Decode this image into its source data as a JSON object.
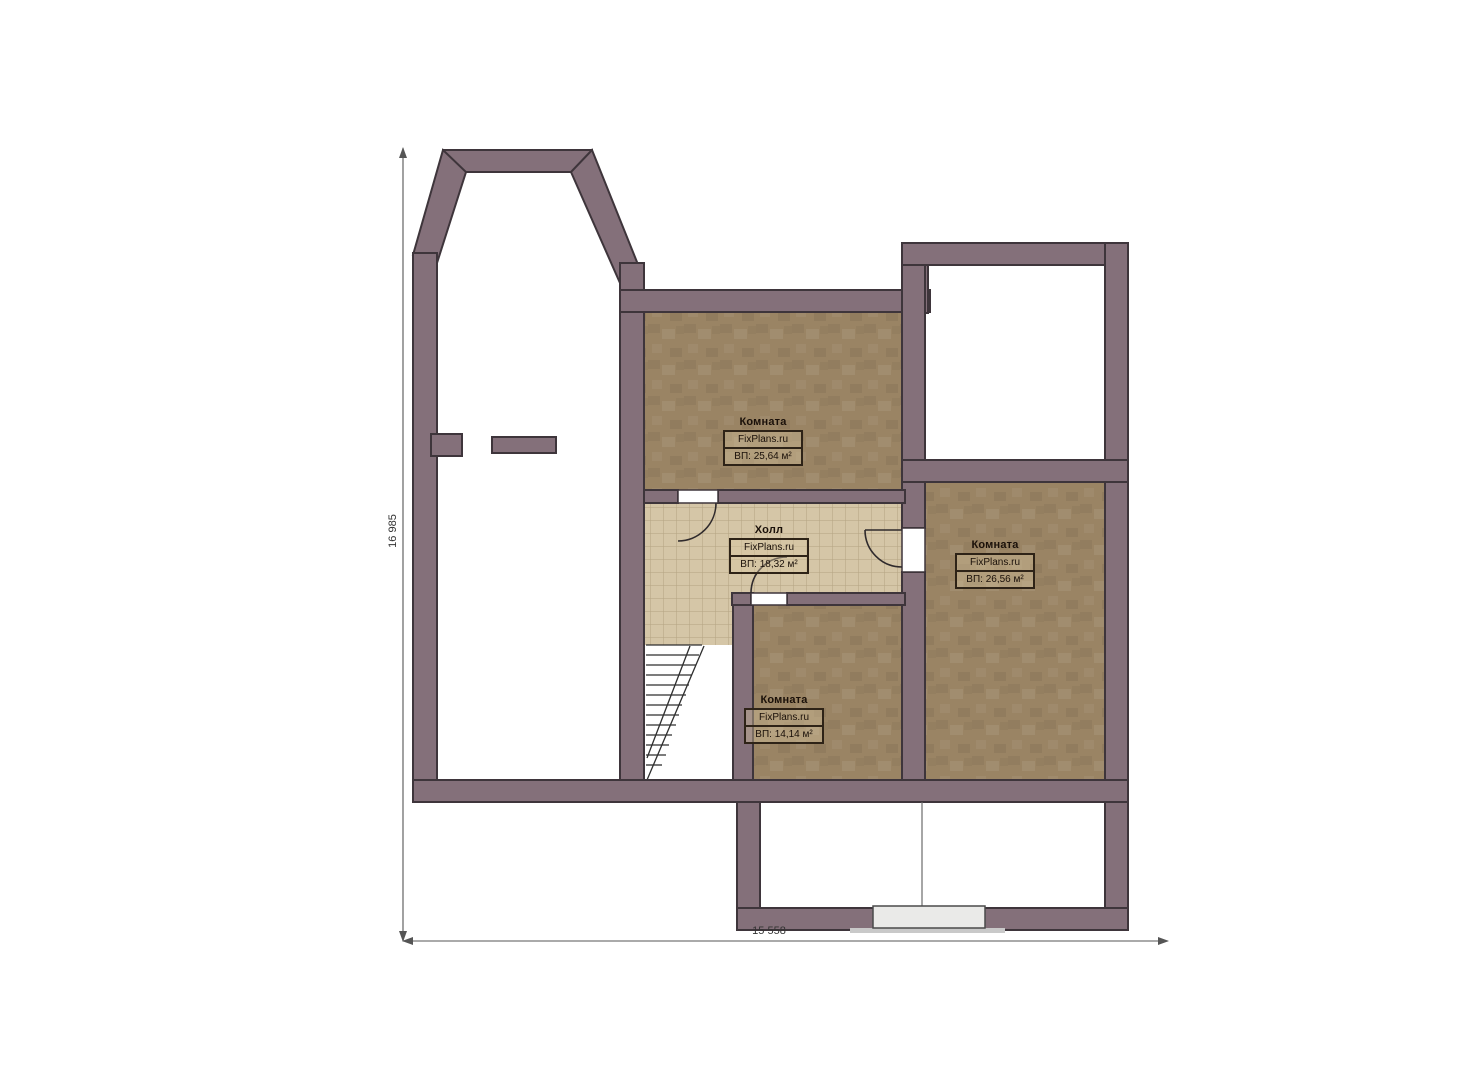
{
  "plan": {
    "brand": "FixPlans.ru",
    "rooms": [
      {
        "name": "Комната",
        "area": "ВП: 25,64 м²"
      },
      {
        "name": "Холл",
        "area": "ВП: 18,32 м²"
      },
      {
        "name": "Комната",
        "area": "ВП: 26,56 м²"
      },
      {
        "name": "Комната",
        "area": "ВП: 14,14 м²"
      }
    ],
    "dimensions": {
      "height": "16 985",
      "width": "15 558"
    },
    "colors": {
      "wall": "#84707a",
      "wall_outline": "#3e353b",
      "floor_wood": "#9a8464",
      "floor_tile": "#d5c6a7",
      "tile_line": "#b3a382",
      "porch_door": "#eaeae8",
      "dim_line": "#555555"
    }
  }
}
